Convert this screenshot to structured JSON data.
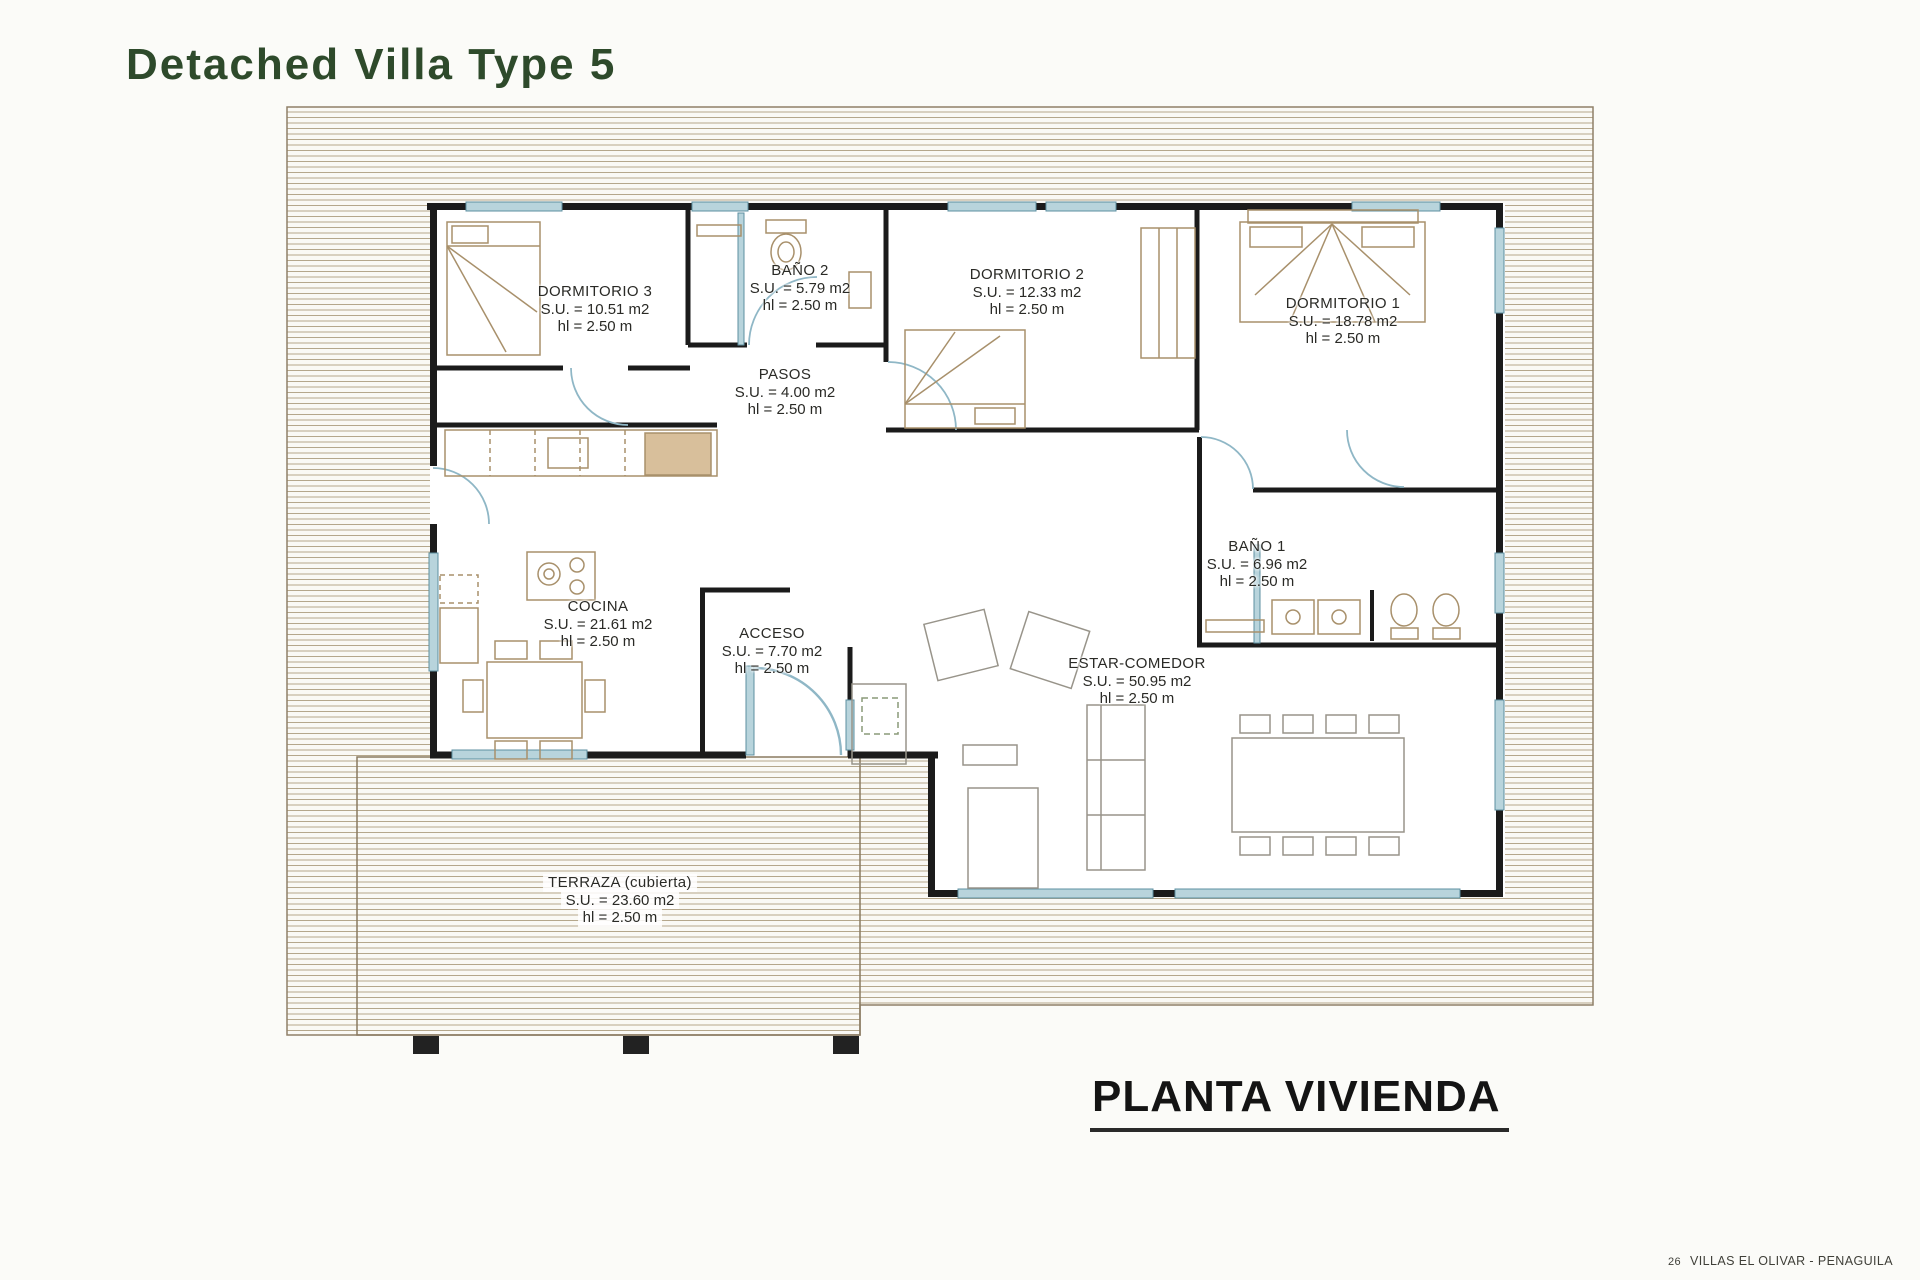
{
  "page": {
    "title": "Detached Villa Type 5",
    "plan_caption": "PLANTA VIVIENDA",
    "footer": {
      "page_number": "26",
      "text": "VILLAS EL OLIVAR - PENAGUILA"
    }
  },
  "colors": {
    "title_green": "#2e4a2b",
    "wall_black": "#1b1b1b",
    "window_blue": "#b8d4dc",
    "hatch_tan": "#b5a78c",
    "furniture_tan": "#a8906b",
    "label_text": "#2a2a26"
  },
  "rooms": [
    {
      "name": "DORMITORIO 3",
      "su": "S.U. = 10.51 m2",
      "hl": "hl = 2.50 m"
    },
    {
      "name": "BAÑO 2",
      "su": "S.U. = 5.79 m2",
      "hl": "hl = 2.50 m"
    },
    {
      "name": "DORMITORIO 2",
      "su": "S.U. = 12.33 m2",
      "hl": "hl = 2.50 m"
    },
    {
      "name": "DORMITORIO 1",
      "su": "S.U. = 18.78 m2",
      "hl": "hl = 2.50 m"
    },
    {
      "name": "PASOS",
      "su": "S.U. = 4.00 m2",
      "hl": "hl = 2.50 m"
    },
    {
      "name": "COCINA",
      "su": "S.U. = 21.61 m2",
      "hl": "hl = 2.50 m"
    },
    {
      "name": "ACCESO",
      "su": "S.U. = 7.70 m2",
      "hl": "hl = 2.50 m"
    },
    {
      "name": "BAÑO 1",
      "su": "S.U. = 6.96 m2",
      "hl": "hl = 2.50 m"
    },
    {
      "name": "ESTAR-COMEDOR",
      "su": "S.U. = 50.95 m2",
      "hl": "hl = 2.50 m"
    },
    {
      "name": "TERRAZA (cubierta)",
      "su": "S.U. = 23.60 m2",
      "hl": "hl = 2.50 m"
    }
  ]
}
